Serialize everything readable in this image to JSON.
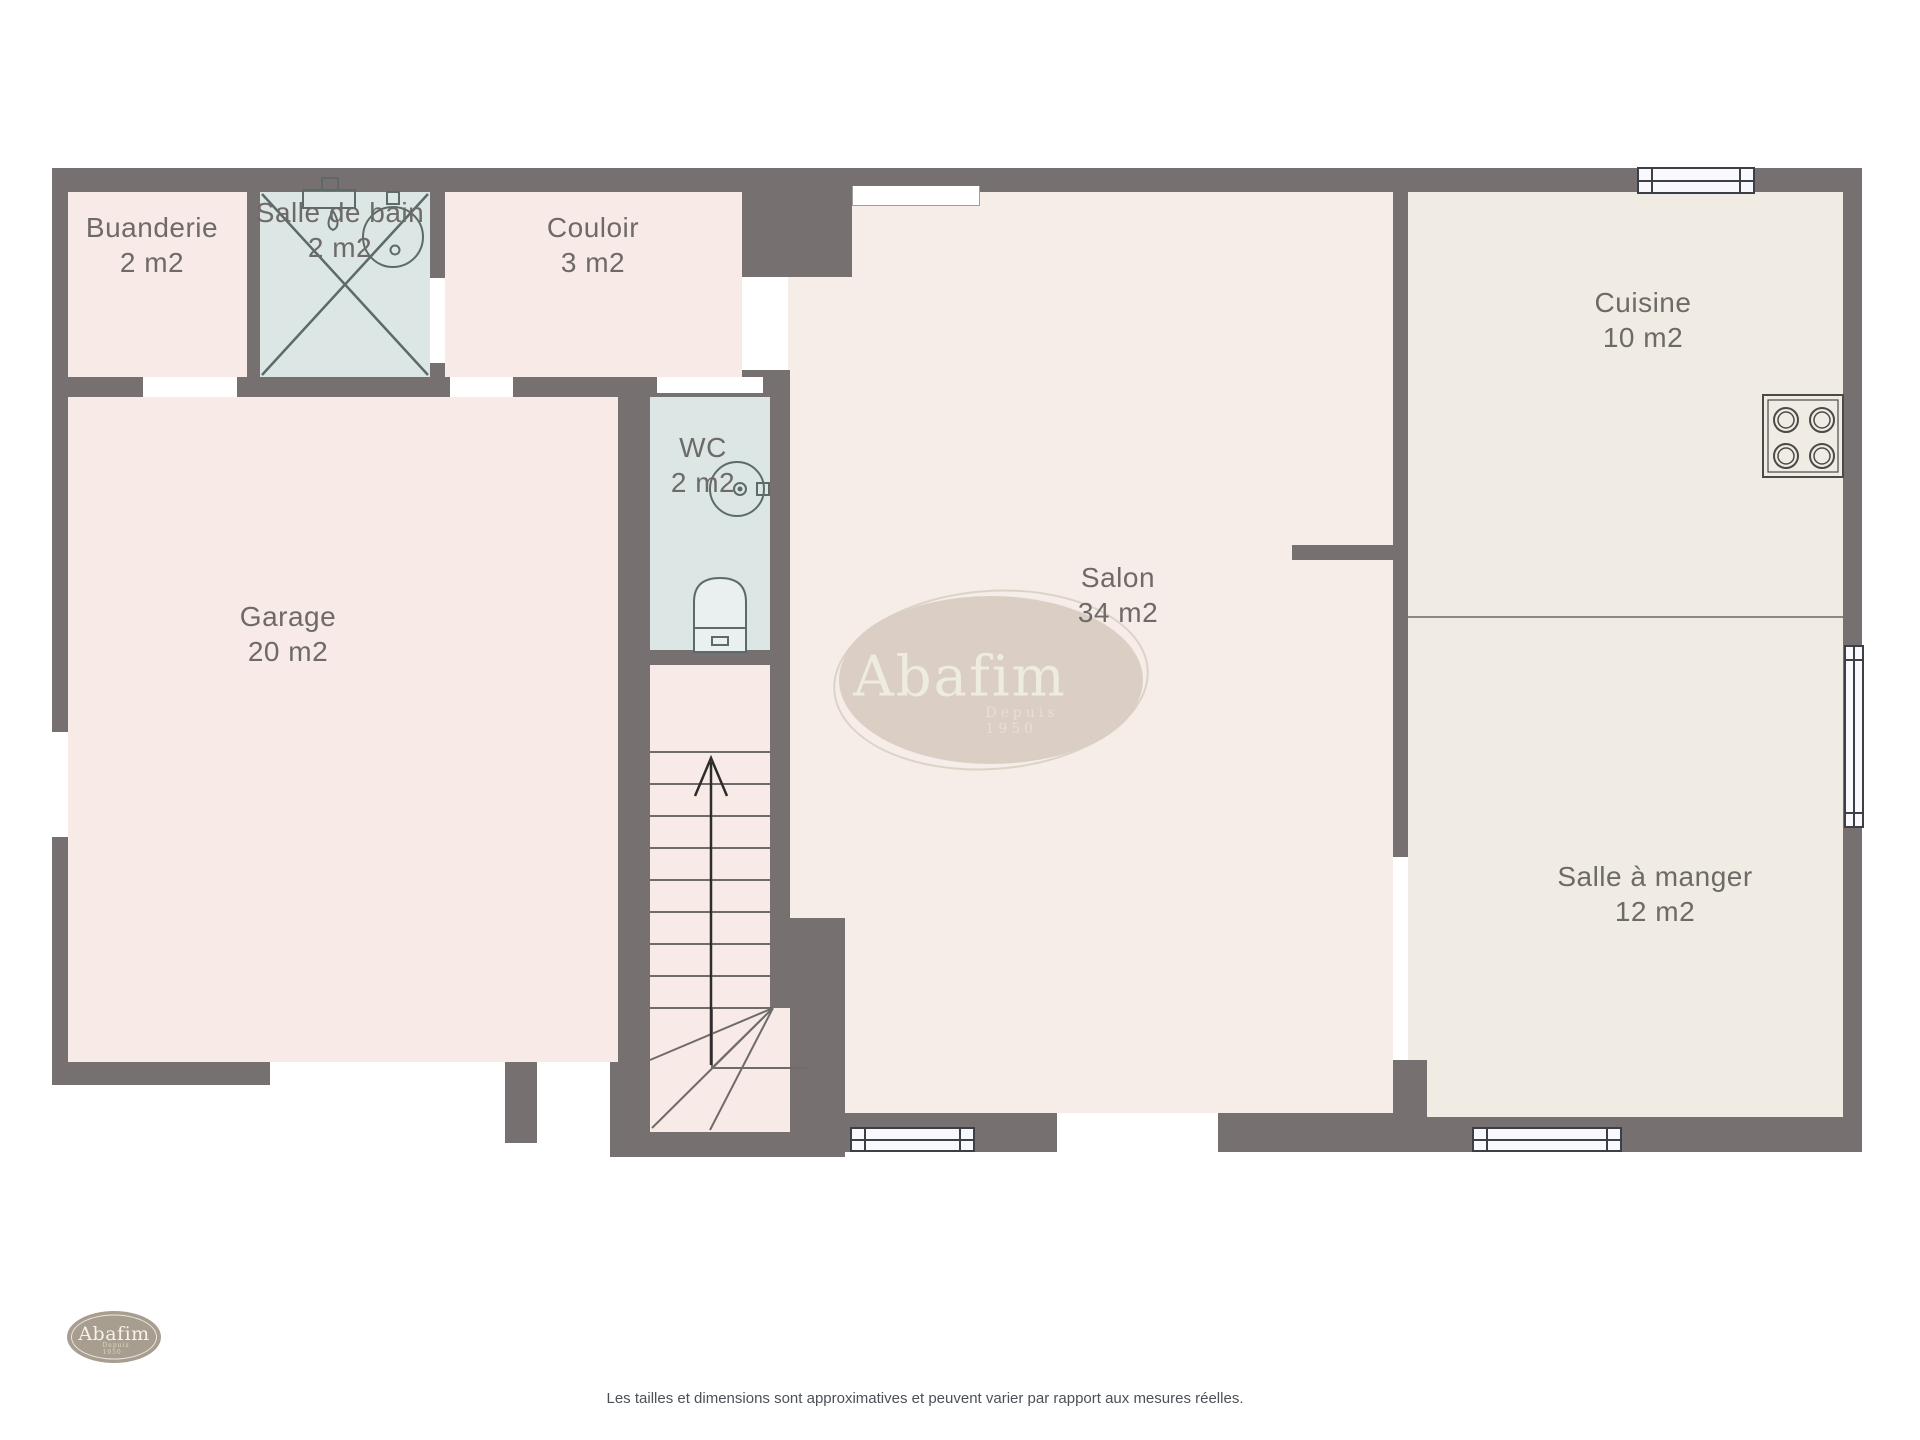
{
  "plan": {
    "title": "Rez-de-chaussée",
    "rooms": [
      {
        "id": "buanderie",
        "name": "Buanderie",
        "area": "2 m2"
      },
      {
        "id": "salle-de-bain",
        "name": "Salle de bain",
        "area": "2 m2"
      },
      {
        "id": "couloir",
        "name": "Couloir",
        "area": "3 m2"
      },
      {
        "id": "wc",
        "name": "WC",
        "area": "2 m2"
      },
      {
        "id": "garage",
        "name": "Garage",
        "area": "20 m2"
      },
      {
        "id": "salon",
        "name": "Salon",
        "area": "34 m2"
      },
      {
        "id": "cuisine",
        "name": "Cuisine",
        "area": "10 m2"
      },
      {
        "id": "salle-a-manger",
        "name": "Salle à manger",
        "area": "12 m2"
      }
    ]
  },
  "watermark": {
    "brand": "Abafim",
    "tagline": "Depuis 1950"
  },
  "logo": {
    "brand": "Abafim",
    "tagline": "Depuis 1950"
  },
  "footer": {
    "disclaimer": "Les tailles et dimensions sont approximatives et peuvent varier par rapport aux mesures réelles."
  },
  "colors": {
    "wall": "#767170",
    "room_pink": "#f8ebe7",
    "room_blue": "#dbe6e5",
    "room_beige": "#f1ece3",
    "watermark_fill": "#c4b8a8",
    "window_frame": "#3b4048",
    "label_text": "#6e6a68"
  }
}
